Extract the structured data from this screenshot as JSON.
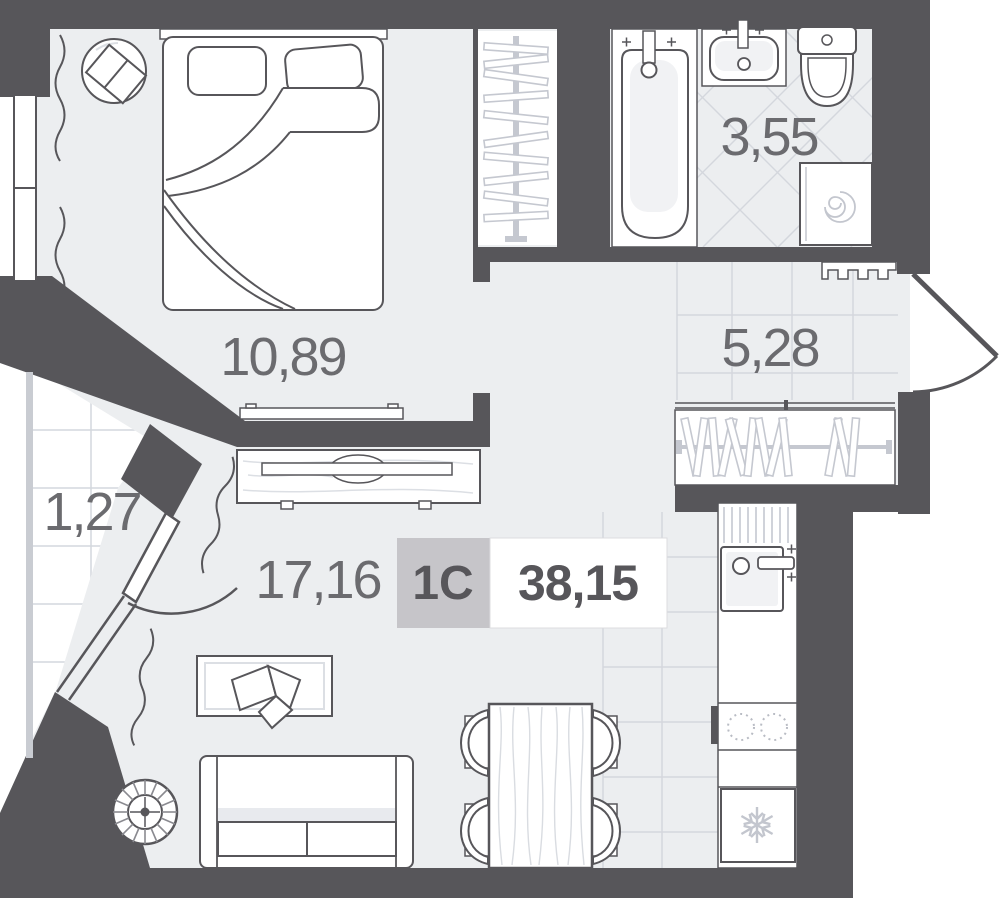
{
  "plan": {
    "unit_badge": {
      "type_label": "1С",
      "total_area": "38,15"
    },
    "rooms": {
      "bedroom": {
        "area": "10,89"
      },
      "bathroom": {
        "area": "3,55"
      },
      "hallway": {
        "area": "5,28"
      },
      "living_kitchen": {
        "area": "17,16"
      },
      "balcony": {
        "area": "1,27"
      }
    },
    "colors": {
      "wall": "#57565a",
      "floor": "#eceef0",
      "tile_line": "#d4d7dd",
      "light_detail": "#c5c8d0",
      "area_text": "#6b6b6f",
      "badge_bg": "#c6c5c9",
      "badge_text": "#57565a"
    }
  }
}
